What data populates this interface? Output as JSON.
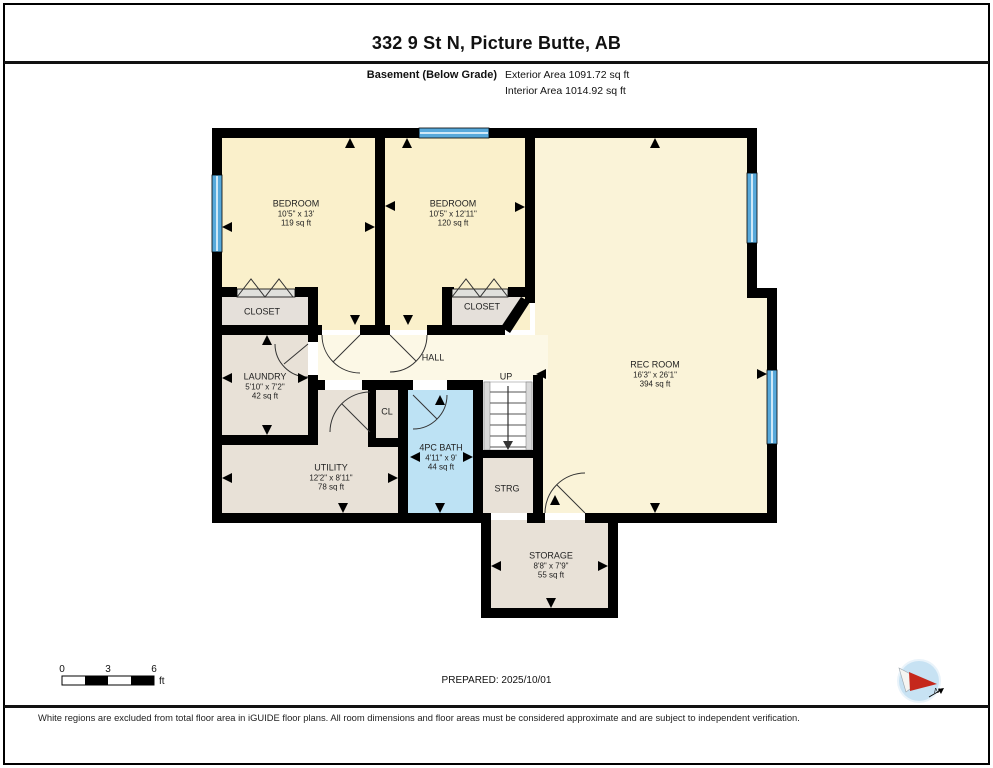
{
  "header": {
    "title": "332 9 St N, Picture Butte, AB",
    "floor_label": "Basement (Below Grade)",
    "areas": [
      "Exterior Area 1091.72 sq ft",
      "Interior Area 1014.92 sq ft"
    ]
  },
  "floorplan": {
    "rooms": {
      "bedroom1": {
        "name": "BEDROOM",
        "dims": "10'5\" x 13'",
        "area": "119 sq ft"
      },
      "bedroom2": {
        "name": "BEDROOM",
        "dims": "10'5\" x 12'11\"",
        "area": "120 sq ft"
      },
      "closet1": {
        "name": "CLOSET"
      },
      "closet2": {
        "name": "CLOSET"
      },
      "laundry": {
        "name": "LAUNDRY",
        "dims": "5'10\" x 7'2\"",
        "area": "42 sq ft"
      },
      "hall": {
        "name": "HALL"
      },
      "cl": {
        "name": "CL"
      },
      "up": {
        "name": "UP"
      },
      "bath": {
        "name": "4PC BATH",
        "dims": "4'11\" x 9'",
        "area": "44 sq ft"
      },
      "utility": {
        "name": "UTILITY",
        "dims": "12'2\" x 8'11\"",
        "area": "78 sq ft"
      },
      "strg": {
        "name": "STRG"
      },
      "recroom": {
        "name": "REC ROOM",
        "dims": "16'3\" x 26'1\"",
        "area": "394 sq ft"
      },
      "storage": {
        "name": "STORAGE",
        "dims": "8'8\" x 7'9\"",
        "area": "55 sq ft"
      }
    },
    "colors": {
      "wall": "#000000",
      "window_blue": "#57A9DB",
      "bath_blue": "#BDE2F4",
      "bedroom_cream": "#FAF0CB",
      "rec_cream": "#FAF3D8",
      "hall_cream": "#FCF8E6",
      "utility_gray": "#E8E1D7"
    }
  },
  "scale_bar": {
    "labels": [
      "0",
      "3",
      "6"
    ],
    "unit": "ft"
  },
  "footer": {
    "prepared": "PREPARED: 2025/10/01",
    "disclaimer": "White regions are excluded from total floor area in iGUIDE floor plans. All room dimensions and floor areas must be considered approximate and are subject to independent verification.",
    "compass_north": "N"
  }
}
